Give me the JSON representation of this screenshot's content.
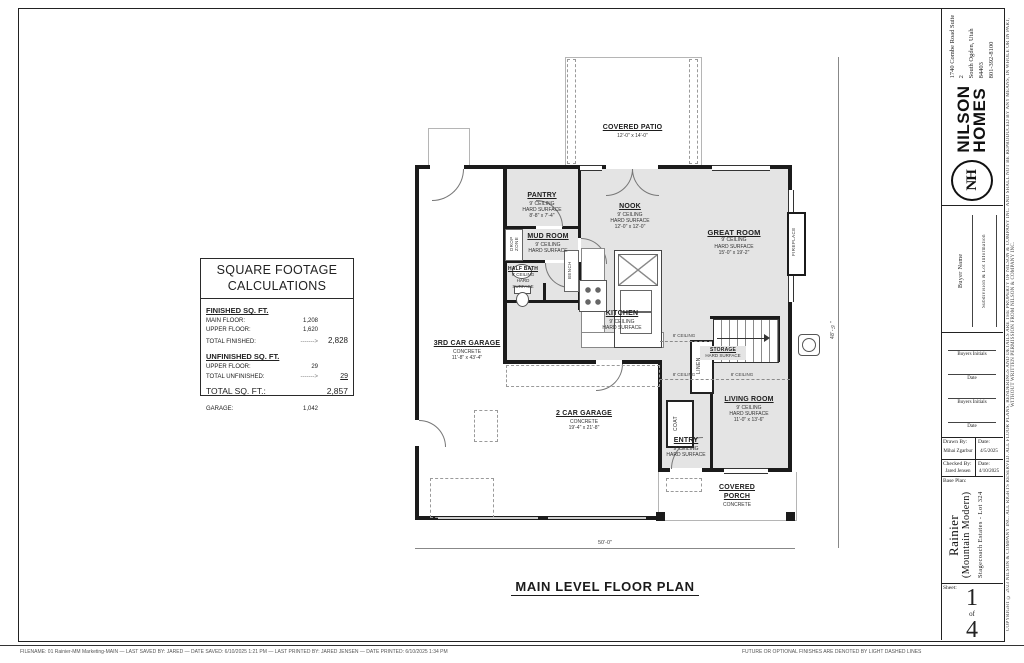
{
  "sheet": {
    "drawing_title": "MAIN LEVEL FLOOR PLAN",
    "footer_filename": "FILENAME:  01 Rainier-MM Marketing-MAIN   —   LAST SAVED BY:  JARED   —   DATE SAVED:  6/10/2025 1:21 PM   —   LAST PRINTED BY:  JARED JENSEN   —   DATE PRINTED:  6/10/2025 1:34 PM",
    "footer_note": "FUTURE OR OPTIONAL FINISHES ARE DENOTED BY LIGHT DASHED LINES",
    "copyright": "COPYRIGHT ©  2023  NILSON & COMPANY INC.  ALL RIGHTS RESERVED.  ALL FLOOR PLANS, RENDERINGS AND DETAILS ARE THE PROPERTY OF NILSON & COMPANY INC. AND SHALL NOT BE REPRODUCED BY ANY MEANS, IN WHOLE OR IN PART, WITHOUT WRITTEN PERMISSION FROM NILSON & COMPANY INC."
  },
  "sqft": {
    "title1": "SQUARE FOOTAGE",
    "title2": "CALCULATIONS",
    "finished_header": "FINISHED SQ. FT.",
    "main_floor_label": "MAIN FLOOR:",
    "main_floor_value": "1,208",
    "upper_floor_label": "UPPER FLOOR:",
    "upper_floor_value": "1,620",
    "total_finished_label": "TOTAL FINISHED:",
    "total_finished_arrow": "------->",
    "total_finished_value": "2,828",
    "unfinished_header": "UNFINISHED SQ. FT.",
    "unf_upper_label": "UPPER FLOOR:",
    "unf_upper_value": "29",
    "total_unfinished_label": "TOTAL UNFINISHED:",
    "total_unfinished_arrow": "------->",
    "total_unfinished_value": "29",
    "total_label": "TOTAL SQ. FT.:",
    "total_value": "2,857",
    "garage_label": "GARAGE:",
    "garage_value": "1,042"
  },
  "plan": {
    "rooms": {
      "covered_patio": {
        "name": "COVERED PATIO",
        "dims": "12'-0\" x 14'-0\""
      },
      "pantry": {
        "name": "PANTRY",
        "ceiling": "9' CEILING",
        "surface": "HARD SURFACE",
        "dims": "8'-8\" x 7'-4\""
      },
      "mud_room": {
        "name": "MUD ROOM",
        "ceiling": "9' CEILING",
        "surface": "HARD SURFACE"
      },
      "half_bath": {
        "name": "HALF BATH",
        "ceiling": "9' CEILING",
        "surface": "HARD SURFACE"
      },
      "nook": {
        "name": "NOOK",
        "ceiling": "9' CEILING",
        "surface": "HARD SURFACE",
        "dims": "12'-0\" x 12'-0\""
      },
      "great_room": {
        "name": "GREAT ROOM",
        "ceiling": "9' CEILING",
        "surface": "HARD SURFACE",
        "dims": "15'-0\" x 19'-2\""
      },
      "kitchen": {
        "name": "KITCHEN",
        "ceiling": "9' CEILING",
        "surface": "HARD SURFACE"
      },
      "storage": {
        "name": "STORAGE",
        "surface": "HARD SURFACE"
      },
      "entry": {
        "name": "ENTRY",
        "ceiling": "9' CEILING",
        "surface": "HARD SURFACE"
      },
      "living_room": {
        "name": "LIVING ROOM",
        "ceiling": "9' CEILING",
        "surface": "HARD SURFACE",
        "dims": "11'-0\" x 13'-6\""
      },
      "covered_porch": {
        "name": "COVERED PORCH",
        "surface": "CONCRETE"
      },
      "third_car_garage": {
        "name": "3RD CAR GARAGE",
        "surface": "CONCRETE",
        "dims": "11'-8\" x 43'-4\""
      },
      "two_car_garage": {
        "name": "2 CAR GARAGE",
        "surface": "CONCRETE",
        "dims": "19'-4\" x 21'-8\""
      }
    },
    "labels": {
      "drop_zone": "DROP ZONE",
      "bench": "BENCH",
      "linen": "LINEN",
      "coat": "COAT",
      "fireplace": "FIREPLACE",
      "ceiling8_a": "8' CEILING",
      "ceiling8_b": "8' CEILING",
      "ceiling8_c": "8' CEILING",
      "dim_width": "50'-0\"",
      "dim_height": "48'-½\""
    }
  },
  "title_block": {
    "logo": {
      "monogram": "NH",
      "brand1": "NILSON",
      "brand2": "HOMES",
      "address1": "1740 Combe Road Suite 2",
      "address2": "South Ogden, Utah 84403",
      "phone": "801-392-8100"
    },
    "buyer_name_label": "Buyer Name",
    "subdivision_label": "Subdivision & Lot Information",
    "initials1": "Buyers Initials",
    "date1": "Date",
    "initials2": "Buyers Initials",
    "date2": "Date",
    "drawn_by_label": "Drawn By:",
    "drawn_by": "Mihai Zgarbur",
    "drawn_date_label": "Date:",
    "drawn_date": "4/5/2025",
    "checked_by_label": "Checked By:",
    "checked_by": "Jared Jensen",
    "checked_date_label": "Date:",
    "checked_date": "4/10/2025",
    "base_plan_label": "Base Plan:",
    "plan_name": "Rainier",
    "plan_style": "(Mountain Modern)",
    "plan_lot": "Stagecoach Estates - Lot 324",
    "sheet_label": "Sheet:",
    "sheet_num": "1",
    "sheet_of": "of",
    "sheet_total": "4"
  }
}
